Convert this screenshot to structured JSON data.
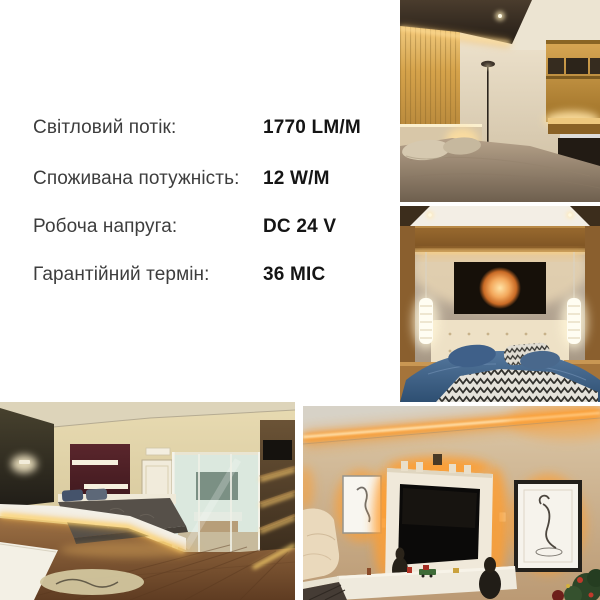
{
  "canvas": {
    "width": 600,
    "height": 600,
    "background": "#ffffff"
  },
  "specs": {
    "rows": [
      {
        "label": "Світловий потік:",
        "value": "1770 LM/M"
      },
      {
        "label": "Споживана потужність:",
        "value": "12 W/M"
      },
      {
        "label": "Робоча напруга:",
        "value": "DC 24 V"
      },
      {
        "label": "Гарантійний термін:",
        "value": "36 МІС"
      }
    ],
    "label_color": "#3d3d3d",
    "value_color": "#151515"
  },
  "photos": [
    {
      "name": "bedroom-wood-slat-cove-lighting"
    },
    {
      "name": "bedroom-pendant-lights-moon-artwork"
    },
    {
      "name": "bedroom-platform-bed-led-strip"
    },
    {
      "name": "living-room-tv-orange-led"
    }
  ],
  "colors": {
    "led_warm": "#ffd98c",
    "led_orange": "#ff9d2e",
    "wood": "#c08f3e",
    "duvet_blue": "#3d608a"
  }
}
